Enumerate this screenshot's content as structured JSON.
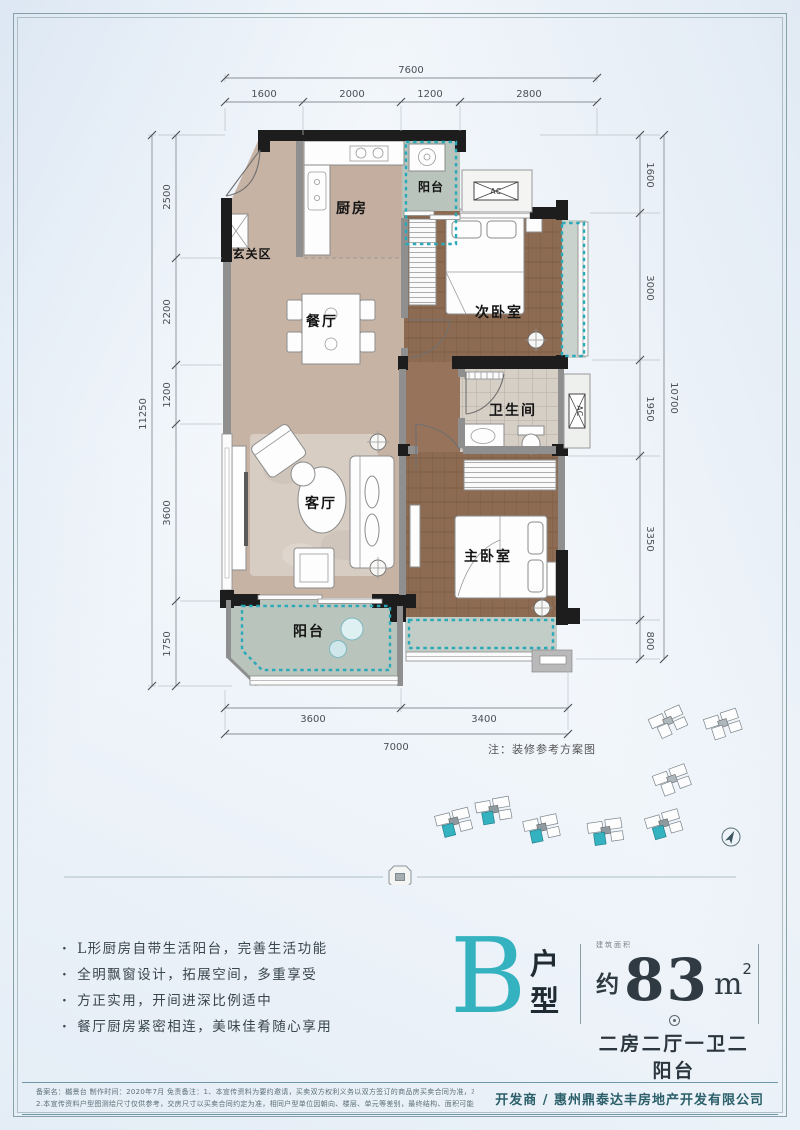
{
  "palette": {
    "teal": "#35b2c0",
    "wall": "#1d1d1d",
    "tile": "#c7b3a4",
    "wood": "#8d6b53",
    "balcony": "#b9c4bd"
  },
  "plan": {
    "rooms": {
      "kitchen": "厨房",
      "kitchen_balcony": "阳台",
      "entry": "玄关区",
      "dining": "餐厅",
      "bedroom2": "次卧室",
      "bath": "卫生间",
      "living": "客厅",
      "master": "主卧室",
      "balcony": "阳台"
    },
    "ac_label": "AC",
    "note": "注：装修参考方案图"
  },
  "dims": {
    "top_total": "7600",
    "top_segments": [
      "1600",
      "2000",
      "1200",
      "2800"
    ],
    "left_total": "11250",
    "left_segments": [
      "2500",
      "2200",
      "1200",
      "3600",
      "1750"
    ],
    "right_total": "10700",
    "right_segments": [
      "1600",
      "3000",
      "1950",
      "3350",
      "800"
    ],
    "bottom_total": "7000",
    "bottom_segments": [
      "3600",
      "3400"
    ]
  },
  "features": [
    "L形厨房自带生活阳台，完善生活功能",
    "全明飘窗设计，拓展空间，多重享受",
    "方正实用，开间进深比例适中",
    "餐厅厨房紧密相连，美味佳肴随心享用"
  ],
  "unit": {
    "letter": "B",
    "type_chars": [
      "户",
      "型"
    ],
    "area_note": "建筑面积",
    "area_prefix": "约",
    "area_value": "83",
    "area_unit": "m",
    "area_sup": "2",
    "layout": "二房二厅一卫二阳台"
  },
  "footer": {
    "disclaimer_line1": "备案名：樾景台 制作时间：2020年7月 免责备注：1、本宣传资料为要约邀请，买卖双方权利义务以双方签订的商品房买卖合同为准，本公司保留对宣传资料修改的权利，敬请留意最新资料。",
    "disclaimer_line2": "2.本宣传资料户型图测绘尺寸仅供参考，交房尺寸以买卖合同约定为准，相同户型单位因朝向、楼层、单元等差别，最终结构、面积可能不同，以实际交付为准。",
    "developer": "开发商 / 惠州鼎泰达丰房地产开发有限公司"
  }
}
